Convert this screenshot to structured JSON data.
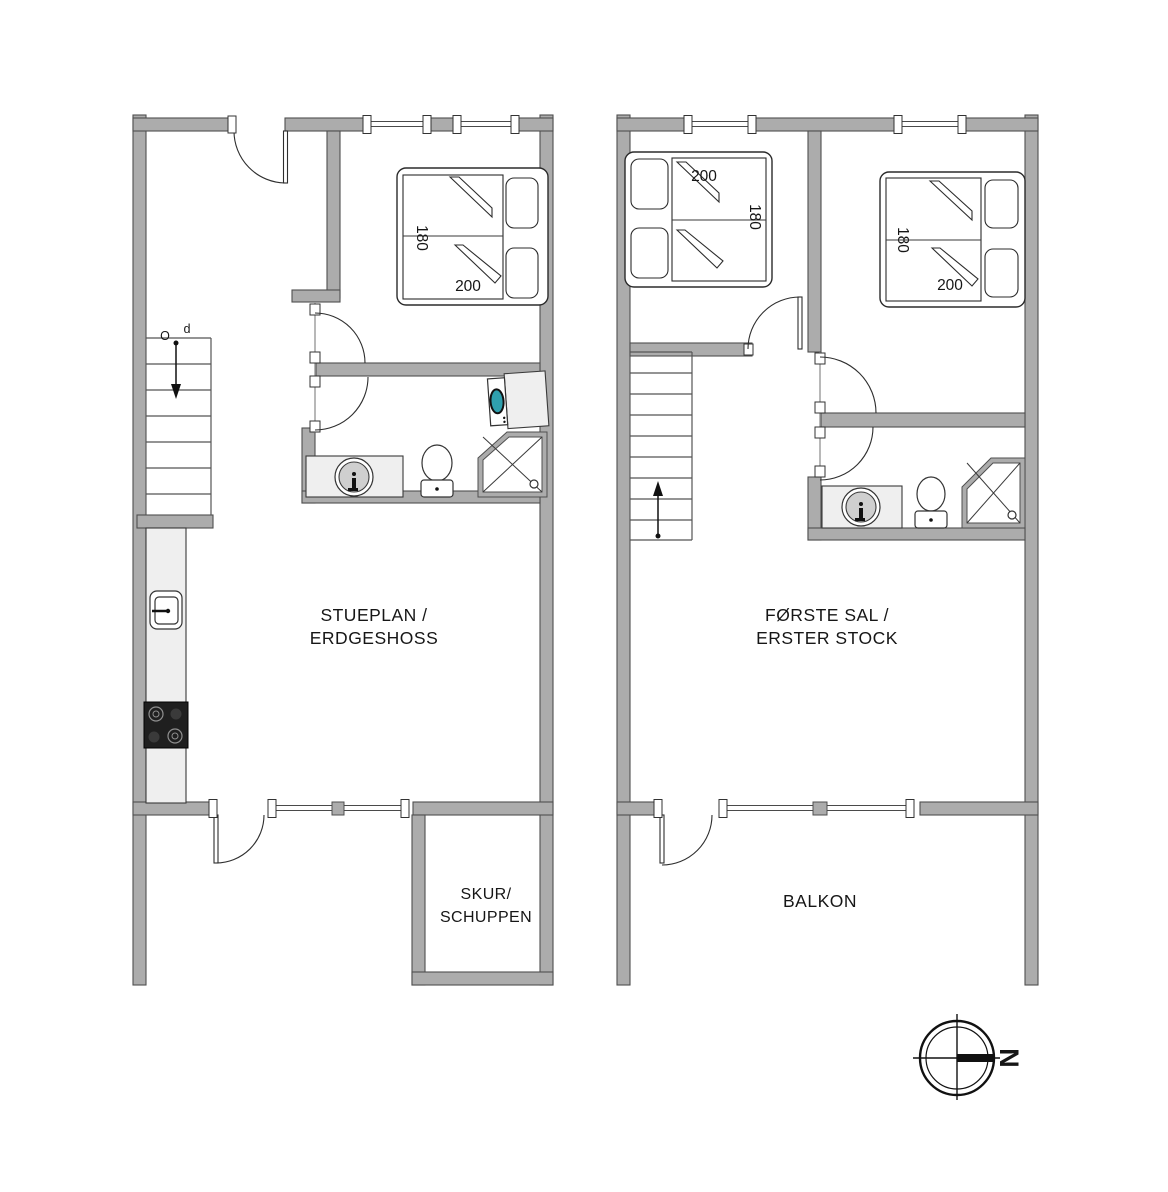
{
  "colors": {
    "wall_fill": "#ACACAC",
    "wall_stroke": "#4F4F4F",
    "washer_door_teal": "#2FA0AE",
    "stove_black": "#1f1f1f",
    "counter_gray": "#efefef"
  },
  "ground_floor": {
    "title_line1": "STUEPLAN /",
    "title_line2": "ERDGESHOSS",
    "shed_line1": "SKUR/",
    "shed_line2": "SCHUPPEN",
    "stairs_label_o": "O",
    "stairs_label_p": "p",
    "bed": {
      "width_label": "180",
      "length_label": "200"
    }
  },
  "first_floor": {
    "title_line1": "FØRSTE SAL /",
    "title_line2": "ERSTER STOCK",
    "balcony_label": "BALKON",
    "bed_left": {
      "width_label": "180",
      "length_label": "200"
    },
    "bed_right": {
      "width_label": "180",
      "length_label": "200"
    }
  },
  "compass": {
    "north_label": "N"
  }
}
